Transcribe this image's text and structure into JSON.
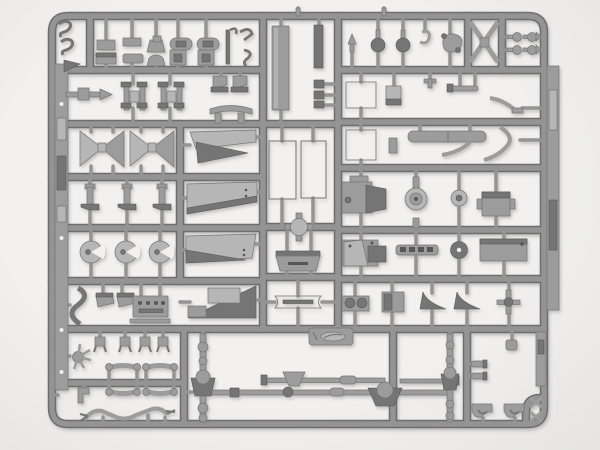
{
  "scene": {
    "type": "photograph",
    "subject": "gray injection-molded plastic model kit sprue (parts tree) with vehicle chassis parts",
    "details": "rectangular runner grid holding frame rails, leaf springs, axles with differentials, drive shafts, radiator panels, engine blocks, wheel hubs, fenders, running boards and many small fittings on a white backdrop",
    "logo_tag": "small embossed manufacturer tag molded below the center runner (marking illegible)"
  },
  "colors": {
    "background": "#f2f1ef",
    "background_edge": "#e5e4e2",
    "runner": "#949494",
    "runner_dark": "#6e6e6e",
    "runner_light": "#c2c2c2",
    "part_light": "#b6b6b6",
    "part_mid": "#9c9c9c",
    "part_dark": "#757575",
    "part_darker": "#575757",
    "rib_light": "#c4c4c4",
    "shadow": "#5a5a5a"
  }
}
